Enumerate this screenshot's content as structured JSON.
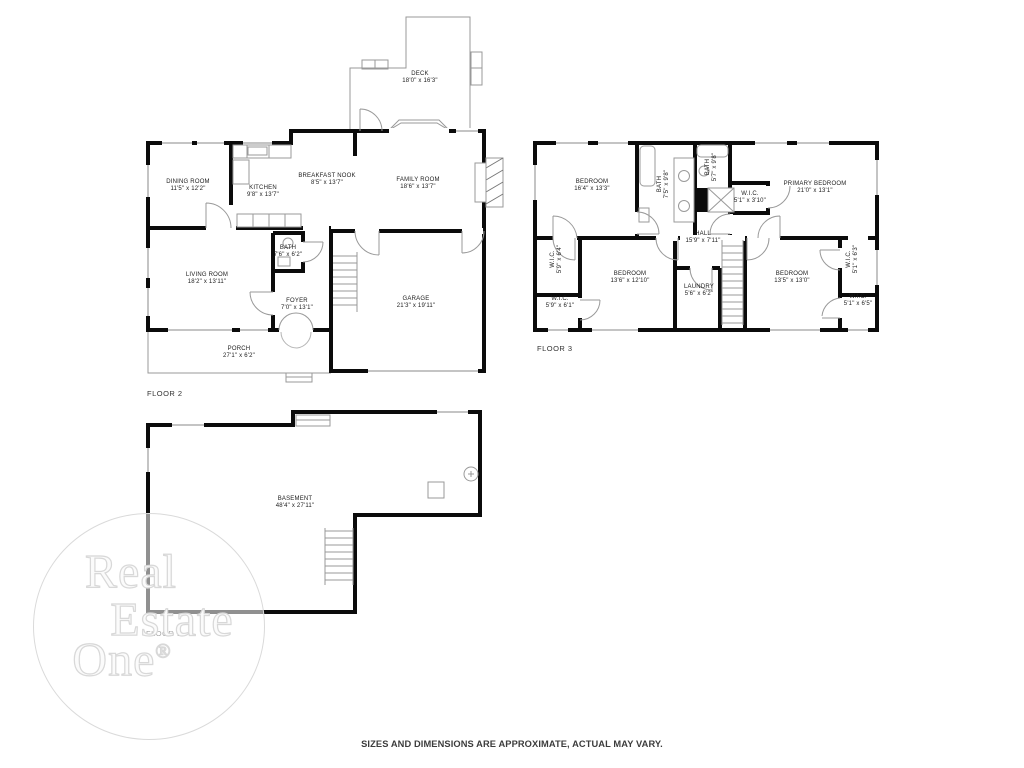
{
  "floors": {
    "floor2": {
      "label": "FLOOR 2",
      "rooms": {
        "deck": {
          "name": "DECK",
          "dims": "18'0\" x 16'3\""
        },
        "dining": {
          "name": "DINING ROOM",
          "dims": "11'5\" x 12'2\""
        },
        "kitchen": {
          "name": "KITCHEN",
          "dims": "9'8\" x 13'7\""
        },
        "breakfast_nook": {
          "name": "BREAKFAST NOOK",
          "dims": "8'5\" x 13'7\""
        },
        "family": {
          "name": "FAMILY ROOM",
          "dims": "18'6\" x 13'7\""
        },
        "bath": {
          "name": "BATH",
          "dims": "7'6\" x 6'2\""
        },
        "living": {
          "name": "LIVING ROOM",
          "dims": "18'2\" x 13'11\""
        },
        "foyer": {
          "name": "FOYER",
          "dims": "7'0\" x 13'1\""
        },
        "garage": {
          "name": "GARAGE",
          "dims": "21'3\" x 19'11\""
        },
        "porch": {
          "name": "PORCH",
          "dims": "27'1\" x 6'2\""
        }
      }
    },
    "floor3": {
      "label": "FLOOR 3",
      "rooms": {
        "bedroom1": {
          "name": "BEDROOM",
          "dims": "16'4\" x 13'3\""
        },
        "bath1": {
          "name": "BATH",
          "dims": "7'5\" x 9'8\""
        },
        "bath2": {
          "name": "BATH",
          "dims": "5'7\" x 9'8\""
        },
        "primary": {
          "name": "PRIMARY BEDROOM",
          "dims": "21'0\" x 13'1\""
        },
        "wic_primary": {
          "name": "W.I.C.",
          "dims": "5'1\" x 3'10\""
        },
        "wic_left_top": {
          "name": "W.I.C.",
          "dims": "5'9\" x 6'4\""
        },
        "bedroom2": {
          "name": "BEDROOM",
          "dims": "13'6\" x 12'10\""
        },
        "hall": {
          "name": "HALL",
          "dims": "15'9\" x 7'11\""
        },
        "laundry": {
          "name": "LAUNDRY",
          "dims": "5'6\" x 6'2\""
        },
        "bedroom3": {
          "name": "BEDROOM",
          "dims": "13'5\" x 13'0\""
        },
        "wic_right_top": {
          "name": "W.I.C.",
          "dims": "5'1\" x 6'3\""
        },
        "wic_left_bottom": {
          "name": "W.I.C.",
          "dims": "5'9\" x 6'1\""
        },
        "wic_right_bottom": {
          "name": "W.I.C.",
          "dims": "5'1\" x 6'5\""
        }
      }
    },
    "floor1": {
      "label": "FLOOR 1",
      "rooms": {
        "basement": {
          "name": "BASEMENT",
          "dims": "48'4\" x 27'11\""
        }
      }
    }
  },
  "watermark": {
    "line1": "Real",
    "line2": "Estate",
    "line3": "One",
    "registered": "®"
  },
  "disclaimer": "SIZES AND DIMENSIONS ARE APPROXIMATE, ACTUAL MAY VARY.",
  "colors": {
    "wall": "#0b0b0b",
    "thin_line": "#999999",
    "watermark_line": "#dcdcdc"
  }
}
